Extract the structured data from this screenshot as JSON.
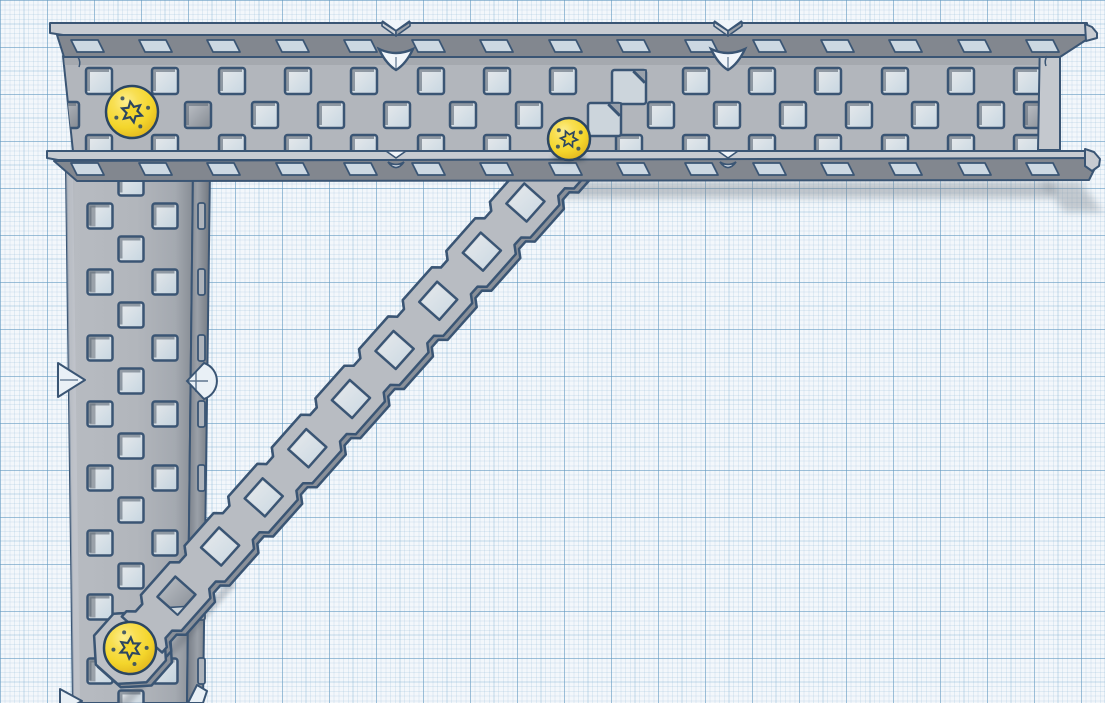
{
  "app": {
    "name": "3D CAD viewport",
    "scene_label": "Workplane with structural channel parts"
  },
  "canvas": {
    "width": 1105,
    "height": 703
  },
  "palette": {
    "bg": "#f0f5fa",
    "outline": "#3a5574",
    "web": "#b2b6bc",
    "web_dark": "#9aa0a8",
    "flange": "#82878f",
    "bevel": "#c7cbd1",
    "end_face": "#c4c8ce",
    "hole_gray_a": "#bfc3c9",
    "hole_gray_b": "#848a92",
    "hole_lip": "#5c6875",
    "stripe": "#8e959e",
    "slot_fill": "rgba(214,228,238,0.88)",
    "thru_tint": "rgba(242,248,252,0.5)",
    "thru_grad_a": "#ffffff",
    "thru_grad_b": "#bcd7e8",
    "brace": "#b8bcc2",
    "brace_edge": "#8a9099",
    "cap": "#bcc0c6",
    "fold_light": "#ccd5dc",
    "fold_dark": "#99a1ab",
    "marker_fill": "#e9f0f6",
    "shadow": "#7e868f",
    "screw_hi": "#fcee8e",
    "screw_mid": "#f4d62c",
    "screw_rim": "#c59d1a",
    "screw_socket": "#2c4661"
  },
  "parts": {
    "horizontal_beam": {
      "label": "horizontal C-channel beam",
      "web_poly": [
        [
          63,
          56
        ],
        [
          1041,
          56
        ],
        [
          1038,
          161
        ],
        [
          74,
          161
        ]
      ],
      "end_face_poly": [
        [
          1040,
          36
        ],
        [
          1060,
          41
        ],
        [
          1060,
          150
        ],
        [
          1038,
          150
        ]
      ],
      "top_bevel_poly": [
        [
          50,
          23
        ],
        [
          1087,
          23
        ],
        [
          1087,
          35
        ],
        [
          63,
          35
        ],
        [
          50,
          33
        ]
      ],
      "top_face_poly": [
        [
          57,
          35
        ],
        [
          1086,
          35
        ],
        [
          1086,
          40
        ],
        [
          1060,
          57
        ],
        [
          64,
          57
        ]
      ],
      "top_tip_poly": [
        [
          1085,
          24
        ],
        [
          1092,
          27
        ],
        [
          1097,
          33
        ],
        [
          1097,
          38
        ],
        [
          1086,
          41
        ]
      ],
      "bot_bevel_poly": [
        [
          47,
          151
        ],
        [
          1086,
          151
        ],
        [
          1086,
          160
        ],
        [
          58,
          160
        ],
        [
          47,
          158
        ]
      ],
      "bot_face_poly": [
        [
          54,
          161
        ],
        [
          1089,
          158
        ],
        [
          1095,
          168
        ],
        [
          1089,
          180
        ],
        [
          77,
          181
        ]
      ],
      "bot_tip_poly": [
        [
          1085,
          149
        ],
        [
          1094,
          152
        ],
        [
          1100,
          159
        ],
        [
          1099,
          166
        ],
        [
          1092,
          171
        ],
        [
          1085,
          166
        ]
      ],
      "slot_centers": [
        88,
        156,
        224,
        293,
        361,
        429,
        497,
        566,
        634,
        702,
        770,
        838,
        906,
        975,
        1043
      ],
      "top_slot_y": [
        40,
        52
      ],
      "bot_slot_y": [
        163,
        175
      ],
      "hole_size": 26,
      "rows": [
        {
          "y": 81,
          "fill": "thru",
          "centers": [
            99,
            165,
            232,
            298,
            364,
            431,
            497,
            563,
            696,
            762,
            828,
            895,
            961,
            1027
          ]
        },
        {
          "y": 115,
          "fill": "gray",
          "centers": [
            66,
            198,
            1037
          ]
        },
        {
          "y": 115,
          "fill": "thru",
          "centers": [
            265,
            331,
            397,
            463,
            529,
            661,
            727,
            793,
            859,
            925,
            991
          ]
        },
        {
          "y": 148,
          "fill": "thru",
          "centers": [
            99,
            165,
            232,
            298,
            364,
            431,
            497,
            563,
            629,
            696,
            762,
            828,
            895,
            961,
            1027
          ]
        }
      ],
      "folded_holes": [
        {
          "x": 612,
          "y": 70,
          "s": 34
        },
        {
          "x": 588,
          "y": 103,
          "s": 33
        }
      ],
      "notch_marks_x": [
        396,
        728
      ],
      "tick_left": "M78,57 q3,5 1,10",
      "tick_right": "M1047,56 q-3,5 -1,10"
    },
    "vertical_beam": {
      "label": "vertical C-channel beam",
      "web_poly": [
        [
          66,
          170
        ],
        [
          193,
          170
        ],
        [
          187,
          703
        ],
        [
          73,
          703
        ]
      ],
      "flange_poly": [
        [
          193,
          170
        ],
        [
          210,
          170
        ],
        [
          203,
          703
        ],
        [
          187,
          703
        ]
      ],
      "bevel_poly": [
        [
          66,
          170
        ],
        [
          73,
          170
        ],
        [
          80,
          703
        ],
        [
          73,
          703
        ]
      ],
      "hole_size": 25,
      "cols": [
        {
          "x": 100,
          "fill": "thru-striped",
          "rows": [
            216,
            282,
            348,
            414,
            478,
            543,
            607,
            671
          ]
        },
        {
          "x": 131,
          "fill": "thru",
          "rows": [
            183,
            249,
            315,
            381,
            446,
            510,
            576,
            641,
            703
          ]
        },
        {
          "x": 165,
          "fill": "thru",
          "rows": [
            216,
            282,
            348,
            414,
            478,
            543,
            607,
            671
          ]
        }
      ],
      "flange_slot_x": 198,
      "flange_slot_w": 7,
      "flange_slot_h": 26,
      "flange_slot_rows": [
        216,
        282,
        348,
        414,
        478,
        543,
        607,
        671
      ],
      "marker_y": 380,
      "bottom_marker_y": 697
    },
    "diagonal_brace": {
      "label": "diagonal flat brace",
      "origin": [
        130,
        648
      ],
      "ux": 0.664,
      "uy": -0.748,
      "half_width": 27,
      "t_start": 18,
      "t_end": 700,
      "notch_start": 36,
      "pitch": 65.7,
      "first_hole_t": 70,
      "hole_count": 9,
      "hole_size": 27,
      "cap_radius": 38,
      "gray_holes": [
        0
      ]
    },
    "screws": [
      {
        "label": "screw-top-left",
        "cx": 132,
        "cy": 112,
        "r": 26,
        "rot": 0.35
      },
      {
        "label": "screw-middle",
        "cx": 569,
        "cy": 139,
        "r": 21,
        "rot": 0.1
      },
      {
        "label": "screw-bottom",
        "cx": 130,
        "cy": 648,
        "r": 26,
        "rot": 0.6
      }
    ],
    "shadows": {
      "beam_band": {
        "x": 557,
        "y": 182,
        "w": 498,
        "h": 16
      },
      "beam_end_poly": [
        [
          1040,
          182
        ],
        [
          1080,
          182
        ],
        [
          1103,
          212
        ],
        [
          1065,
          212
        ]
      ],
      "brace_on_beam": {
        "t0": -50,
        "t1": 118,
        "w": 33
      },
      "screw_mid_ellipse": {
        "cx": 569,
        "cy": 158,
        "rx": 17,
        "ry": 4.5
      }
    }
  }
}
